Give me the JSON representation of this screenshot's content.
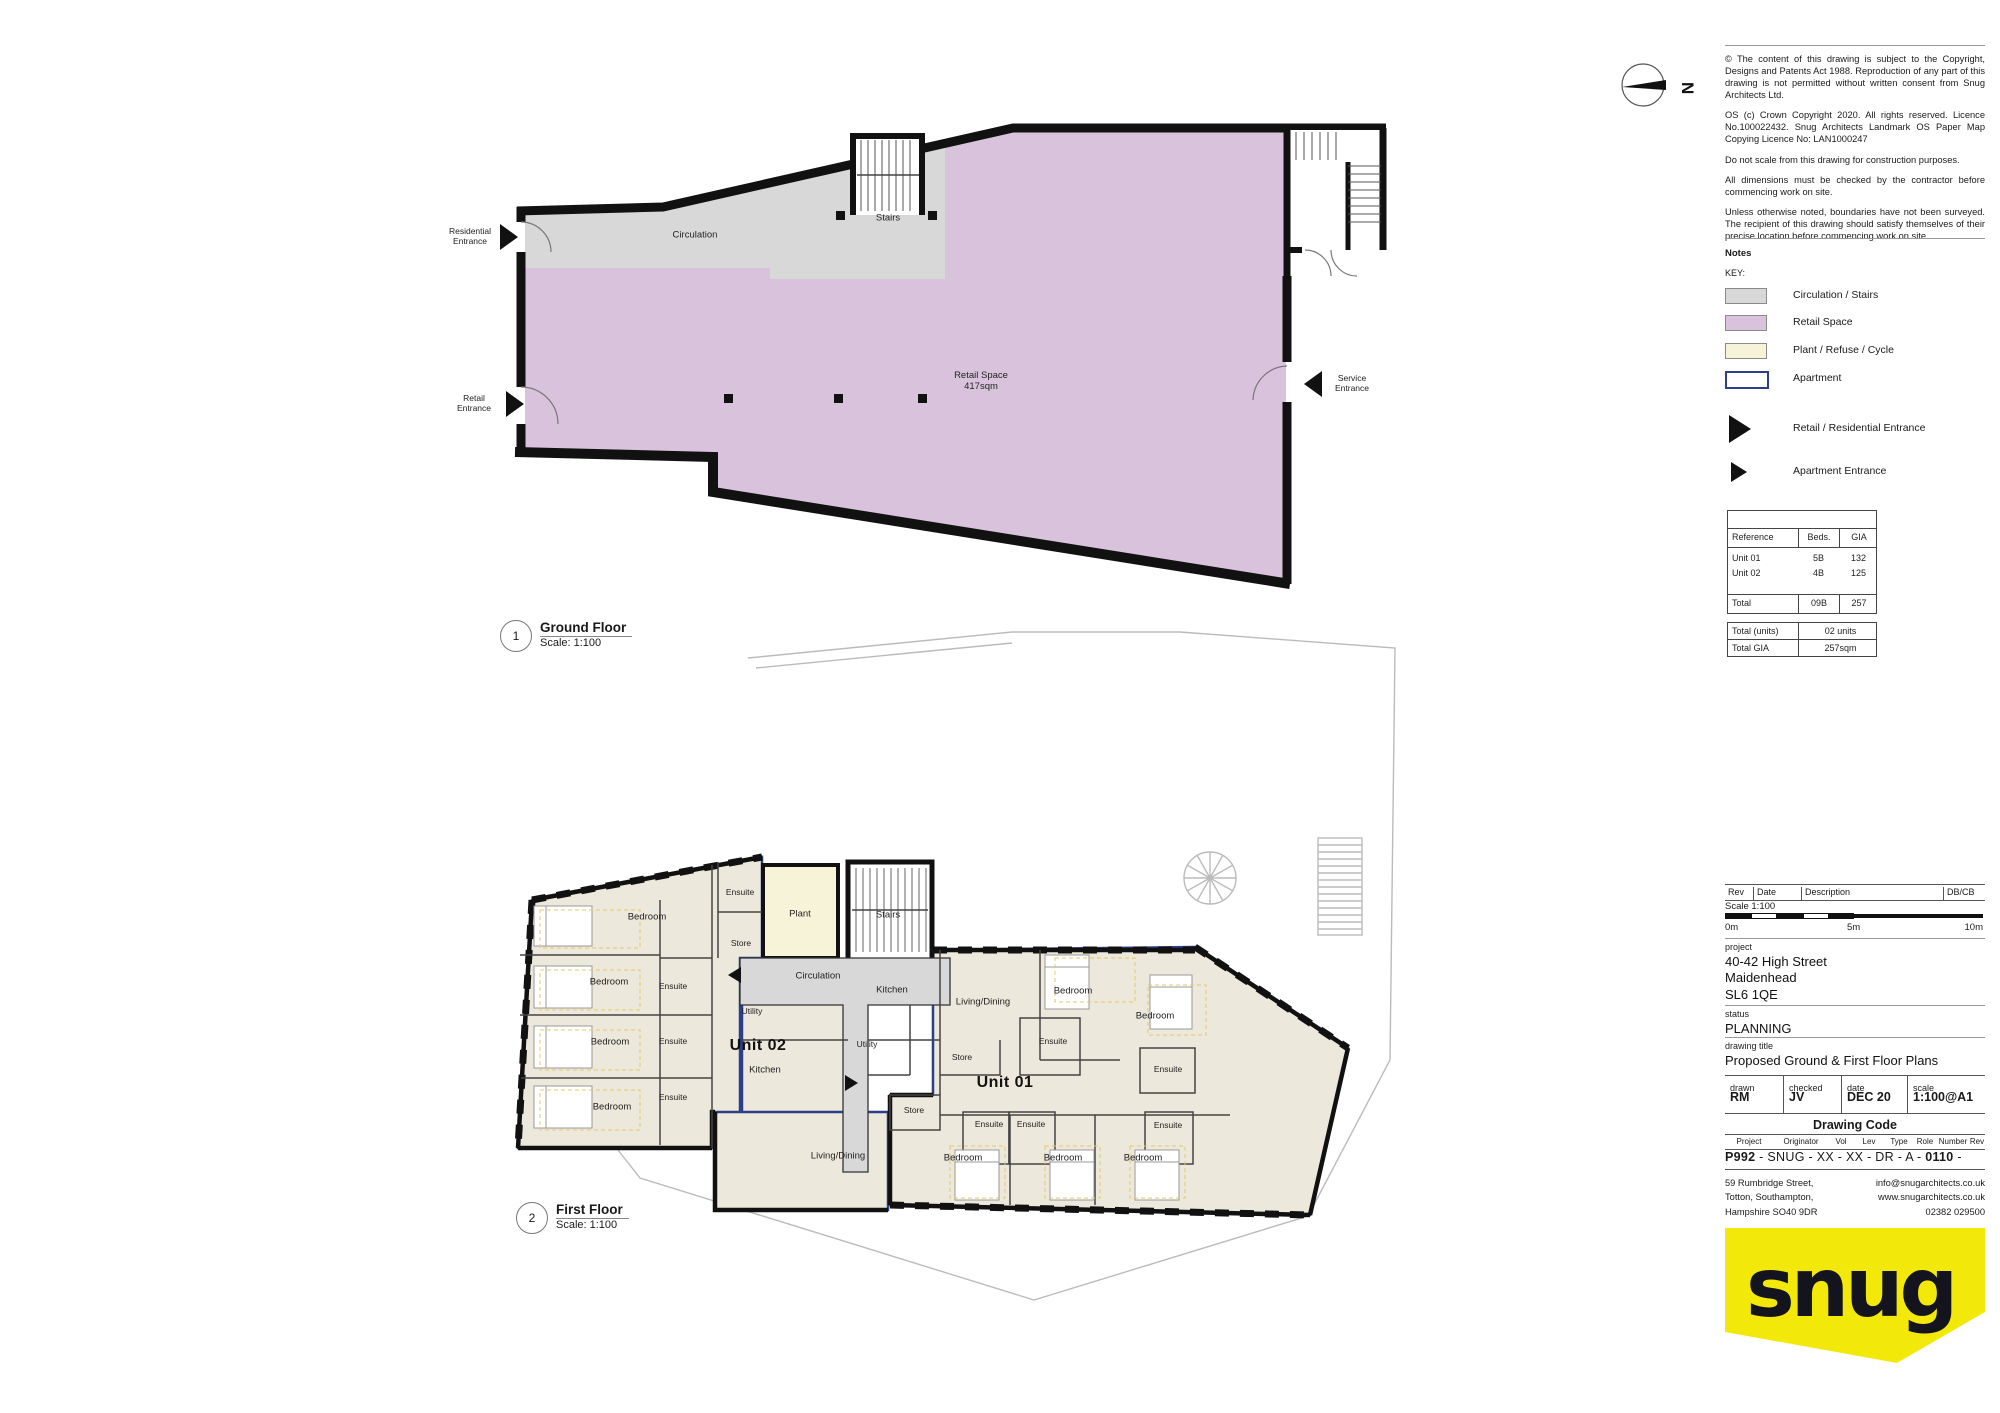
{
  "north_label": "N",
  "colors": {
    "circulation": "#D8D8D8",
    "retail": "#D9C3DC",
    "plant": "#F7F3D9",
    "apartment_outline": "#2E3E87",
    "room_fill": "#EDE8DC",
    "wall": "#1A1A1A",
    "logo_yellow": "#F2E90A"
  },
  "notes_panel": {
    "copyright_paragraphs": [
      "© The content of this drawing is subject to the Copyright, Designs and Patents Act 1988. Reproduction of any part of this drawing is not permitted without written consent from Snug Architects Ltd.",
      "OS (c) Crown Copyright 2020. All rights reserved. Licence No.100022432. Snug Architects Landmark OS Paper Map Copying Licence No: LAN1000247",
      "Do not scale from this drawing for construction purposes.",
      "All dimensions must be checked by the contractor before commencing work on site.",
      "Unless otherwise noted, boundaries have not been surveyed. The recipient of this drawing should satisfy themselves of their precise location before commencing work on site."
    ],
    "notes_label": "Notes",
    "key_label": "KEY:",
    "key_items": [
      {
        "label": "Circulation / Stairs",
        "color": "#D8D8D8"
      },
      {
        "label": "Retail Space",
        "color": "#D9C3DC"
      },
      {
        "label": "Plant / Refuse / Cycle",
        "color": "#F7F3D9"
      },
      {
        "label": "Apartment",
        "color": "#FFFFFF"
      }
    ],
    "entrance_items": [
      {
        "label": "Retail / Residential Entrance"
      },
      {
        "label": "Apartment Entrance"
      }
    ]
  },
  "area_table": {
    "headers": [
      "Reference",
      "Beds.",
      "GIA"
    ],
    "rows": [
      [
        "Unit 01",
        "5B",
        "132"
      ],
      [
        "Unit 02",
        "4B",
        "125"
      ]
    ],
    "total_row": [
      "Total",
      "09B",
      "257"
    ],
    "summary_rows": [
      [
        "Total (units)",
        "02 units"
      ],
      [
        "Total GIA",
        "257sqm"
      ]
    ]
  },
  "title_block": {
    "rev_headers": [
      "Rev",
      "Date",
      "Description",
      "DB/CB"
    ],
    "scale_label": "Scale 1:100",
    "scale_ticks": [
      "0m",
      "5m",
      "10m"
    ],
    "project_label": "project",
    "project_lines": [
      "40-42 High Street",
      "Maidenhead",
      "SL6 1QE"
    ],
    "status_label": "status",
    "status_value": "PLANNING",
    "drawing_title_label": "drawing title",
    "drawing_title_value": "Proposed Ground & First Floor Plans",
    "meta_headers": [
      "drawn",
      "checked",
      "date",
      "scale"
    ],
    "meta_values": [
      "RM",
      "JV",
      "DEC 20",
      "1:100@A1"
    ],
    "drawing_code_heading": "Drawing Code",
    "code_headers": [
      "Project",
      "Originator",
      "Vol",
      "Lev",
      "Type",
      "Role",
      "Number",
      "Rev"
    ],
    "code_line_prefix": "P992",
    "code_line_mid": " - SNUG - XX - XX - DR - A - ",
    "code_line_number": "0110",
    "code_line_suffix": " -",
    "address_lines": [
      "59 Rumbridge Street,",
      "Totton, Southampton,",
      "Hampshire SO40 9DR"
    ],
    "contact_lines": [
      "info@snugarchitects.co.uk",
      "www.snugarchitects.co.uk",
      "02382 029500"
    ],
    "logo_text": "snug"
  },
  "ground_floor": {
    "marker": "1",
    "title": "Ground Floor",
    "scale": "Scale: 1:100",
    "labels": [
      {
        "t": "Residential\nEntrance",
        "x": 470,
        "y": 237,
        "cls": "ent"
      },
      {
        "t": "Circulation",
        "x": 695,
        "y": 236,
        "cls": "room"
      },
      {
        "t": "Stairs",
        "x": 888,
        "y": 219,
        "cls": "room"
      },
      {
        "t": "Retail\nEntrance",
        "x": 474,
        "y": 404,
        "cls": "ent"
      },
      {
        "t": "Retail Space\n417sqm",
        "x": 981,
        "y": 382,
        "cls": "room"
      },
      {
        "t": "Service\nEntrance",
        "x": 1352,
        "y": 384,
        "cls": "ent"
      }
    ]
  },
  "first_floor": {
    "marker": "2",
    "title": "First Floor",
    "scale": "Scale: 1:100",
    "labels": [
      {
        "t": "Ensuite",
        "x": 740,
        "y": 893,
        "cls": "sm"
      },
      {
        "t": "Bedroom",
        "x": 647,
        "y": 918,
        "cls": "room"
      },
      {
        "t": "Plant",
        "x": 800,
        "y": 915,
        "cls": "room"
      },
      {
        "t": "Stairs",
        "x": 888,
        "y": 916,
        "cls": "room"
      },
      {
        "t": "Store",
        "x": 741,
        "y": 944,
        "cls": "sm"
      },
      {
        "t": "Circulation",
        "x": 818,
        "y": 977,
        "cls": "room"
      },
      {
        "t": "Bedroom",
        "x": 609,
        "y": 983,
        "cls": "room"
      },
      {
        "t": "Ensuite",
        "x": 673,
        "y": 987,
        "cls": "sm"
      },
      {
        "t": "Utility",
        "x": 752,
        "y": 1012,
        "cls": "sm"
      },
      {
        "t": "Ensuite",
        "x": 673,
        "y": 1042,
        "cls": "sm"
      },
      {
        "t": "Bedroom",
        "x": 610,
        "y": 1043,
        "cls": "room"
      },
      {
        "t": "Unit 02",
        "x": 758,
        "y": 1046,
        "cls": "unit"
      },
      {
        "t": "Kitchen",
        "x": 765,
        "y": 1071,
        "cls": "room"
      },
      {
        "t": "Ensuite",
        "x": 673,
        "y": 1098,
        "cls": "sm"
      },
      {
        "t": "Bedroom",
        "x": 612,
        "y": 1108,
        "cls": "room"
      },
      {
        "t": "Kitchen",
        "x": 892,
        "y": 991,
        "cls": "room"
      },
      {
        "t": "Living/Dining",
        "x": 983,
        "y": 1003,
        "cls": "room"
      },
      {
        "t": "Bedroom",
        "x": 1073,
        "y": 992,
        "cls": "room"
      },
      {
        "t": "Bedroom",
        "x": 1155,
        "y": 1017,
        "cls": "room"
      },
      {
        "t": "Ensuite",
        "x": 1053,
        "y": 1042,
        "cls": "sm"
      },
      {
        "t": "Utility",
        "x": 867,
        "y": 1045,
        "cls": "sm"
      },
      {
        "t": "Store",
        "x": 962,
        "y": 1058,
        "cls": "sm"
      },
      {
        "t": "Unit 01",
        "x": 1005,
        "y": 1083,
        "cls": "unit"
      },
      {
        "t": "Ensuite",
        "x": 1168,
        "y": 1070,
        "cls": "sm"
      },
      {
        "t": "Store",
        "x": 914,
        "y": 1111,
        "cls": "sm"
      },
      {
        "t": "Ensuite",
        "x": 989,
        "y": 1125,
        "cls": "sm"
      },
      {
        "t": "Ensuite",
        "x": 1031,
        "y": 1125,
        "cls": "sm"
      },
      {
        "t": "Ensuite",
        "x": 1168,
        "y": 1126,
        "cls": "sm"
      },
      {
        "t": "Living/Dining",
        "x": 838,
        "y": 1157,
        "cls": "room"
      },
      {
        "t": "Bedroom",
        "x": 963,
        "y": 1159,
        "cls": "room"
      },
      {
        "t": "Bedroom",
        "x": 1063,
        "y": 1159,
        "cls": "room"
      },
      {
        "t": "Bedroom",
        "x": 1143,
        "y": 1159,
        "cls": "room"
      }
    ]
  }
}
